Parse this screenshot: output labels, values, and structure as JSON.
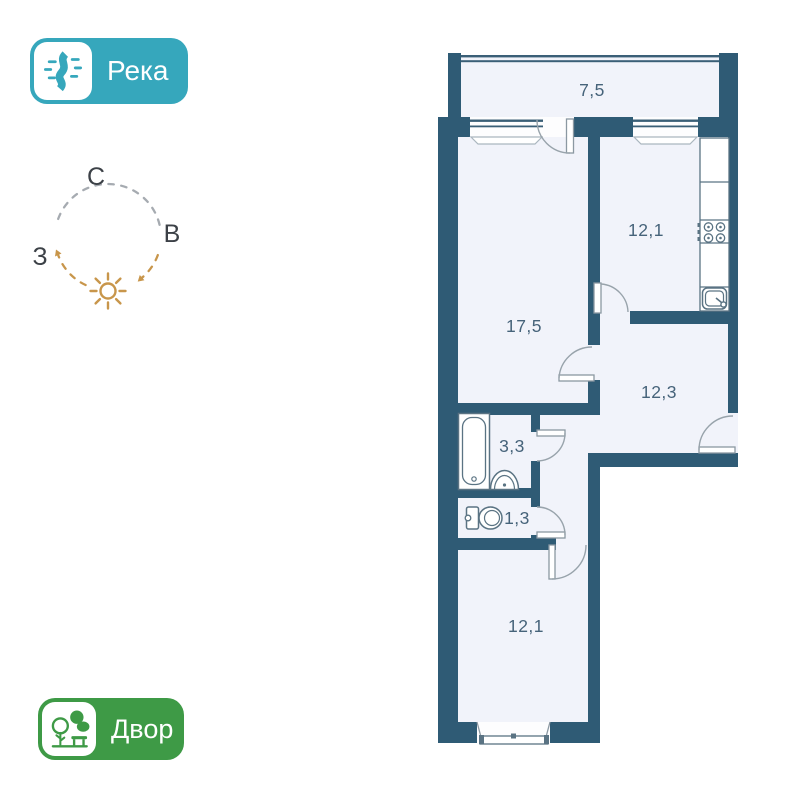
{
  "badges": {
    "river": {
      "label": "Река"
    },
    "yard": {
      "label": "Двор"
    }
  },
  "compass": {
    "north_label": "С",
    "east_label": "В",
    "west_label": "З"
  },
  "floor_plan": {
    "rooms": [
      {
        "id": "balcony",
        "area": "7,5"
      },
      {
        "id": "living-room",
        "area": "17,5"
      },
      {
        "id": "kitchen",
        "area": "12,1"
      },
      {
        "id": "hallway",
        "area": "12,3"
      },
      {
        "id": "bathroom",
        "area": "3,3"
      },
      {
        "id": "toilet",
        "area": "1,3"
      },
      {
        "id": "bedroom",
        "area": "12,1"
      }
    ]
  },
  "colors": {
    "wall": "#2f5b75",
    "floor": "#f1f3fa",
    "glaze": "#3a5f77",
    "label": "#46637a",
    "fixture": "#5a7383",
    "leaf": "#8b98a2",
    "arc": "#98a3ab",
    "sill": "#aab6bf",
    "dash_gray": "#a6abb1",
    "accent_orange": "#c8964b",
    "letter": "#3c4147",
    "river_badge": "#36a7bc",
    "yard_badge": "#3e9a46"
  }
}
